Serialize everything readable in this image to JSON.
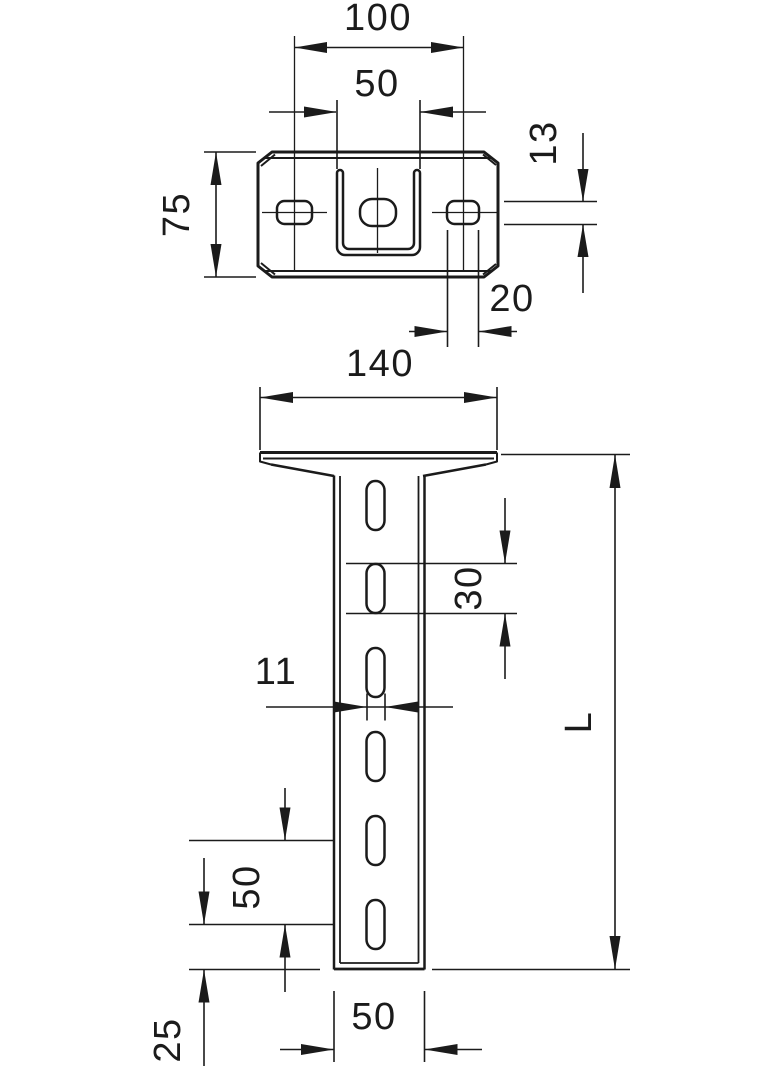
{
  "drawing": {
    "type": "technical-dimension-drawing",
    "background_color": "#ffffff",
    "line_color": "#1b1b1b",
    "top_view": {
      "description": "head plate seen from above with U-profile, center hole and two side slots",
      "dimensions": {
        "slot_center_spacing": "100",
        "profile_width": "50",
        "plate_depth": "75",
        "side_slot_height": "13",
        "side_slot_width": "20"
      }
    },
    "front_view": {
      "description": "vertical slotted U-profile post welded under the head plate",
      "dimensions": {
        "plate_width": "140",
        "slot_length": "30",
        "slot_width": "11",
        "total_length": "L",
        "slot_pitch": "50",
        "bottom_end_distance": "25",
        "post_width": "50"
      }
    }
  }
}
